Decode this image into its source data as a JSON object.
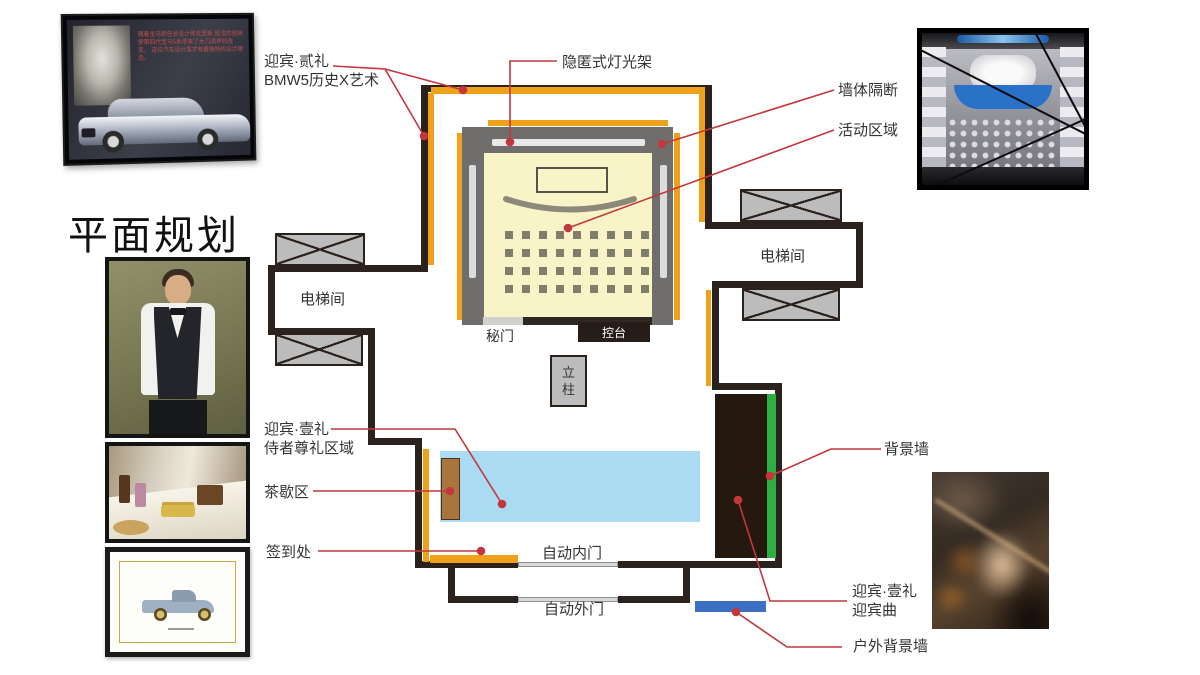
{
  "page": {
    "title": "平面规划"
  },
  "colors": {
    "wall": "#2b211d",
    "light_rack_orange": "#f0a11a",
    "leader_red": "#c2363c",
    "activity_yellow": "#f8f4c8",
    "pool_blue": "#abdbf2",
    "backdrop_green": "#2fae45",
    "outdoor_wall_blue": "#3c6fc2"
  },
  "plan": {
    "callouts": {
      "welcome_second": {
        "line1": "迎宾·贰礼",
        "line2": "BMW5历史X艺术"
      },
      "hidden_light_rack": "隐匿式灯光架",
      "wall_partition": "墙体隔断",
      "activity_area": "活动区域",
      "background_wall": "背景墙",
      "welcome_first_service": {
        "line1": "迎宾·壹礼",
        "line2": "侍者尊礼区域"
      },
      "tea_break_area": "茶歇区",
      "sign_in_desk": "签到处",
      "welcome_first_music": {
        "line1": "迎宾·壹礼",
        "line2": "迎宾曲"
      },
      "outdoor_background_wall": "户外背景墙"
    },
    "rooms": {
      "elevator_left": "电梯间",
      "elevator_right": "电梯间",
      "secret_door": "秘门",
      "console": "控台",
      "pillar": "立柱",
      "inner_door": "自动内门",
      "outer_door": "自动外门"
    }
  },
  "photos": {
    "bmw_history": {
      "text_line1": "随着宝马新任总设计师克里斯·班戈的到来",
      "text_line2": "使第四代宝马5系带来了大刀阔斧的改变，",
      "text_line3": "这位汽车设计鬼才有着独特的设计理念。"
    }
  }
}
